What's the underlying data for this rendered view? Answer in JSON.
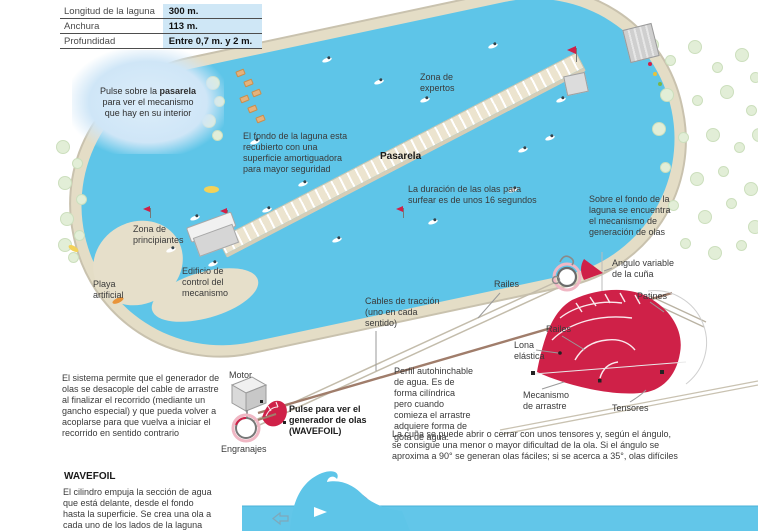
{
  "colors": {
    "water": "#5ec5e8",
    "accent_crimson": "#cf2148",
    "sand": "#e4ddc6",
    "table_value_bg": "#cfe7f6",
    "bubble_bg": "#cfe6f7",
    "label_text": "#3a3a3a"
  },
  "table": {
    "rows": [
      {
        "label": "Longitud de la laguna",
        "value": "300 m."
      },
      {
        "label": "Anchura",
        "value": "113 m."
      },
      {
        "label": "Profundidad",
        "value": "Entre 0,7 m. y 2 m."
      }
    ]
  },
  "bubble": {
    "pre": "Pulse sobre la ",
    "bold": "pasarela",
    "post": " para ver el mecanismo que hay en su interior"
  },
  "map_labels": {
    "zona_expertos": "Zona de\nexpertos",
    "fondo": "El fondo de la laguna esta\nrecubierto con una\nsuperficie amortiguadora\npara mayor seguridad",
    "pasarela": "Pasarela",
    "duracion": "La duración de las olas para\nsurfear es de unos 16 segundos",
    "zona_principiantes": "Zona de\nprincipiantes",
    "playa": "Playa\nartificial",
    "edificio": "Edificio de\ncontrol del\nmecanismo",
    "sobre_fondo": "Sobre el fondo de la\nlaguna se encuentra\nel mecanismo de\ngeneración de olas"
  },
  "mechanism_labels": {
    "angulo": "Angulo variable\nde la cuña",
    "patines": "Patines",
    "railes_upper": "Railes",
    "railes_lower": "Railes",
    "lona": "Lona\nelástica",
    "mecanismo_arrastre": "Mecanismo\nde arrastre",
    "tensores": "Tensores",
    "cables": "Cables de tracción\n(uno en cada\nsentido)",
    "motor": "Motor",
    "engranajes": "Engranajes",
    "pulse_generador": "Pulse para ver el\ngenerador de olas\n(WAVEFOIL)"
  },
  "paragraphs": {
    "sistema": "El sistema permite que el generador de\nolas se desacople del cable de arrastre\nal finalizar el recorrido (mediante un\ngancho especial) y que pueda volver a\nacoplarse para que vuelva a iniciar el\nrecorrido en sentido contrario",
    "perfil": "Perfil autohinchable\nde agua. Es de\nforma cilíndrica\npero cuando\ncomieza el arrastre\nadquiere forma de\ngota de agua.",
    "cuna": "La cuña se puede abrir o cerrar con unos tensores y, según el ángulo,\nse consigue una menor o mayor dificultad de la ola. Si el ángulo se\naproxima a 90° se generan olas fáciles; si se acerca a 35°, olas difíciles",
    "wavefoil_title": "WAVEFOIL",
    "wavefoil_body": "El cilindro empuja la sección de agua\nque está delante, desde el fondo\nhasta la superficie. Se crea una ola a\ncada uno de los lados de la laguna"
  }
}
